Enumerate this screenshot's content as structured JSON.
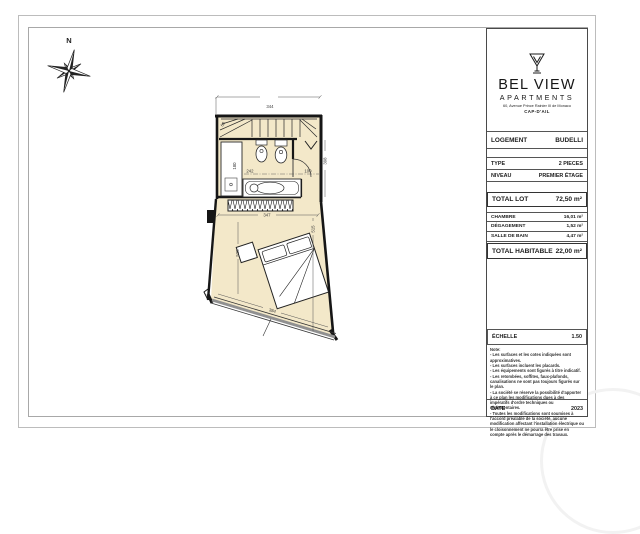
{
  "compass": {
    "north_label": "N"
  },
  "title_block": {
    "brand": {
      "line1": "BEL VIEW",
      "line2": "APARTMENTS",
      "address": "60, Avenue Prince Rainier III de Monaco",
      "city": "CAP-D'AIL"
    },
    "logement": {
      "label": "LOGEMENT",
      "value": "BUDELLI"
    },
    "type": {
      "label": "TYPE",
      "value": "2 PIECES"
    },
    "niveau": {
      "label": "NIVEAU",
      "value": "PREMIER ÉTAGE"
    },
    "total_lot": {
      "label": "TOTAL LOT",
      "value": "72,50 m²"
    },
    "areas": [
      {
        "label": "CHAMBRE",
        "value": "16,01 m²"
      },
      {
        "label": "DÉGAGEMENT",
        "value": "1,52 m²"
      },
      {
        "label": "SALLE DE BAIN",
        "value": "4,47 m²"
      }
    ],
    "total_habitable": {
      "label": "TOTAL HABITABLE",
      "value": "22,00 m²"
    },
    "echelle": {
      "label": "ÉCHELLE",
      "value": "1.50"
    },
    "note_lines": [
      "Note:",
      "- Les surfaces et les cotes indiquées sont approximatives.",
      "- Les surfaces incluent les placards.",
      "- Les équipements sont figurés à titre indicatif.",
      "- Les retombées, soffites, faux-plafonds, canalisations ne sont pas toujours figurés sur le plan.",
      "- La société se réserve la possibilité d'apporter à ce plan les modifications dues à des impératifs d'ordre techniques ou réglementaires.",
      "- Toutes les modifications sont soumises à l'accord préalable de la société, aucune modification affectant l'installation électrique ou le cloisonnement ne pourra être prise en compte après le démarrage des travaux."
    ],
    "date": {
      "label": "DATE",
      "value": "2023"
    }
  },
  "floor_plan": {
    "dimensions": {
      "stair_width": "344",
      "stair_winder": "60",
      "shower_depth": "180",
      "bathtub_width": "242",
      "niche_width": "100",
      "right_wall_height": "398",
      "bedroom_width": "347",
      "bedroom_depth_right": "515",
      "bedroom_depth_left": "525",
      "window_width": "384"
    },
    "colors": {
      "floor_fill": "#f3e8c9",
      "wall": "#161616",
      "window_band": "#909090"
    }
  }
}
